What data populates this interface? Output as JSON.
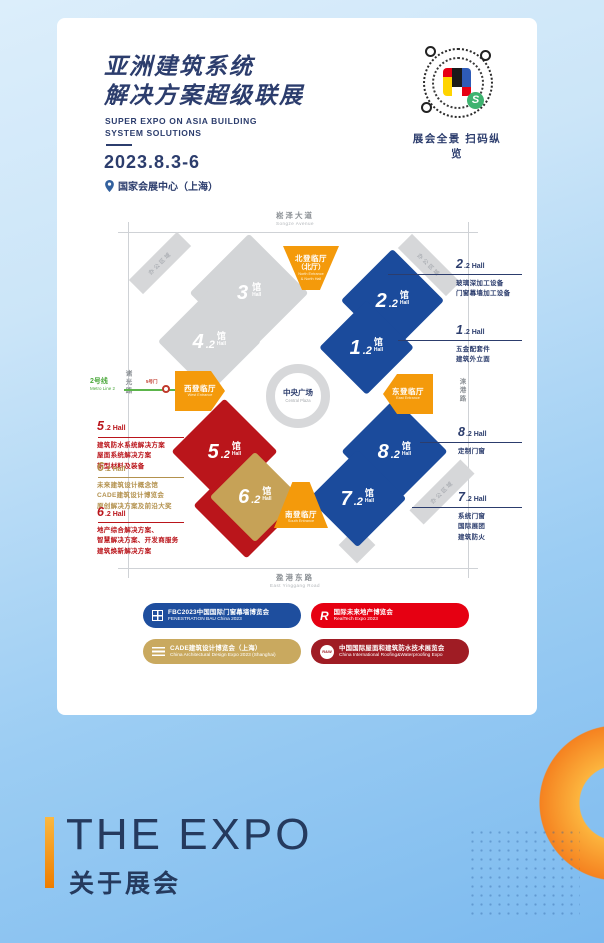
{
  "colors": {
    "navy": "#2c3d6d",
    "hall_blue": "#1b4b9c",
    "hall_red": "#ba151b",
    "hall_gold": "#c6a257",
    "hall_gray": "#d3d5d7",
    "entrance_orange": "#f49a0b",
    "metro_green": "#4ba83b",
    "accent_orange": "#f58220",
    "bg_blue": "#7cbaef",
    "legend_blue": "#1e4e9e",
    "legend_red": "#e60012",
    "legend_gold": "#c9a95f",
    "legend_darkred": "#9f1c24"
  },
  "header": {
    "title_line1": "亚洲建筑系统",
    "title_line2": "解决方案超级联展",
    "subtitle_line1": "SUPER EXPO ON ASIA BUILDING",
    "subtitle_line2": "SYSTEM SOLUTIONS",
    "date": "2023.8.3-6",
    "venue": "国家会展中心（上海）"
  },
  "qr": {
    "caption": "展会全景 扫码纵览",
    "badge_glyph": "S"
  },
  "map": {
    "roads": {
      "north_zh": "崧泽大道",
      "north_en": "Songze Avenue",
      "south_zh": "盈港东路",
      "south_en": "East Yinggang Road",
      "west_zh": "诸光路",
      "east_zh": "涞港路"
    },
    "metro": {
      "line_zh": "2号线",
      "line_en": "Metro Line 2",
      "gate": "5号门"
    },
    "plaza": {
      "zh": "中央广场",
      "en": "Central Plaza"
    },
    "office_area": "办公区域",
    "entrances": {
      "north": {
        "zh": "北登临厅",
        "zh2": "（北厅）",
        "en1": "North Entrance",
        "en2": "& North Hall"
      },
      "west": {
        "zh": "西登临厅",
        "en": "West Entrance"
      },
      "east": {
        "zh": "东登临厅",
        "en": "East Entrance"
      },
      "south": {
        "zh": "南登临厅",
        "en": "South Entrance"
      }
    },
    "halls": {
      "h3": {
        "num": "3",
        "dec": "",
        "unit": "馆",
        "en": "Hall"
      },
      "h42": {
        "num": "4",
        "dec": ".2",
        "unit": "馆",
        "en": "Hall"
      },
      "h22": {
        "num": "2",
        "dec": ".2",
        "unit": "馆",
        "en": "Hall"
      },
      "h12": {
        "num": "1",
        "dec": ".2",
        "unit": "馆",
        "en": "Hall"
      },
      "h52": {
        "num": "5",
        "dec": ".2",
        "unit": "馆",
        "en": "Hall"
      },
      "h62": {
        "num": "6",
        "dec": ".2",
        "unit": "馆",
        "en": "Hall"
      },
      "h82": {
        "num": "8",
        "dec": ".2",
        "unit": "馆",
        "en": "Hall"
      },
      "h72": {
        "num": "7",
        "dec": ".2",
        "unit": "馆",
        "en": "Hall"
      }
    },
    "callouts": {
      "c22": {
        "num": "2",
        "suffix": ".2 Hall",
        "line1": "玻璃深加工设备",
        "line2": "门窗幕墙加工设备"
      },
      "c12": {
        "num": "1",
        "suffix": ".2 Hall",
        "line1": "五金配套件",
        "line2": "建筑外立面"
      },
      "c82": {
        "num": "8",
        "suffix": ".2 Hall",
        "line1": "定制门窗"
      },
      "c72": {
        "num": "7",
        "suffix": ".2 Hall",
        "line1": "系统门窗",
        "line2": "国际展团",
        "line3": "建筑防火"
      },
      "c52": {
        "num": "5",
        "suffix": ".2 Hall",
        "line1": "建筑防水系统解决方案",
        "line2": "屋面系统解决方案",
        "line3": "新型材料及装备"
      },
      "c62g": {
        "num": "6",
        "suffix": ".2 Hall",
        "line1": "未来建筑设计概念馆",
        "line2": "CADE建筑设计博览会",
        "line3": "原创解决方案及前沿大奖"
      },
      "c62r": {
        "num": "6",
        "suffix": ".2 Hall",
        "line1": "地产综合解决方案、",
        "line2": "智慧解决方案、开发商服务",
        "line3": "建筑焕新解决方案"
      }
    }
  },
  "legend": [
    {
      "zh": "FBC2023中国国际门窗幕墙博览会",
      "en": "FENESTRATION BAU China 2023"
    },
    {
      "zh": "国际未来地产博览会",
      "en": "RealTech Expo 2023"
    },
    {
      "zh": "CADE建筑设计博览会（上海）",
      "en": "China Architectural Design Expo 2023 (Shanghai)"
    },
    {
      "zh": "中国国际屋面和建筑防水技术展览会",
      "en": "China International Roofing&Waterproofing Expo"
    },
    {
      "rw_icon_text": "R&W",
      "r_icon_text": "R"
    }
  ],
  "footer": {
    "title": "THE EXPO",
    "subtitle": "关于展会"
  }
}
